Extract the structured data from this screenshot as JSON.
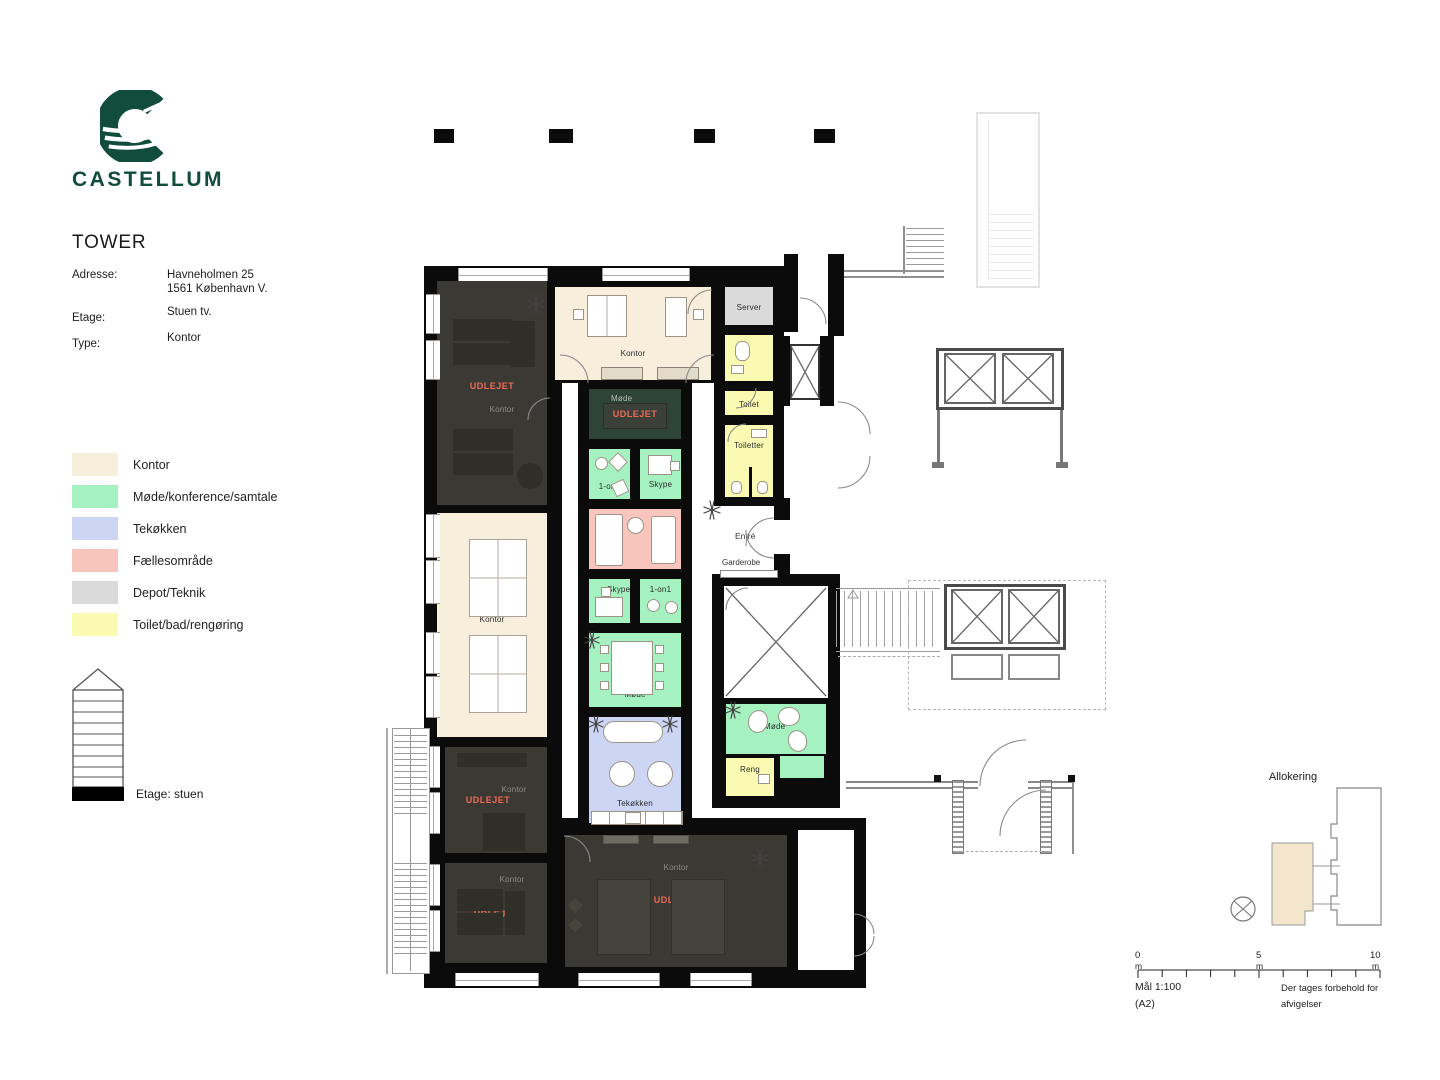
{
  "brand": {
    "name": "CASTELLUM",
    "logo_color": "#114c3c"
  },
  "header": {
    "title": "TOWER",
    "address_label": "Adresse:",
    "address_line1": "Havneholmen 25",
    "address_line2": "1561 København V.",
    "floor_label": "Etage:",
    "floor_value": "Stuen tv.",
    "type_label": "Type:",
    "type_value": "Kontor"
  },
  "legend": {
    "items": [
      {
        "label": "Kontor",
        "color": "#f7eedb"
      },
      {
        "label": "Møde/konference/samtale",
        "color": "#a5f1c0"
      },
      {
        "label": "Tekøkken",
        "color": "#ccd5f4"
      },
      {
        "label": "Fællesområde",
        "color": "#f7c5bc"
      },
      {
        "label": "Depot/Teknik",
        "color": "#dadada"
      },
      {
        "label": "Toilet/bad/rengøring",
        "color": "#fafab2"
      }
    ],
    "floor_note": "Etage: stuen"
  },
  "plan": {
    "status_color": "#ee6a55",
    "rooms": {
      "a1": {
        "label": "Kontor",
        "status": "UDLEJET"
      },
      "a2": {
        "label": "Kontor"
      },
      "a3": {
        "label": "Kontor",
        "status": "UDLEJET"
      },
      "a4": {
        "label": "Kontor",
        "status": "UDLEJET"
      },
      "b1": {
        "label": "Kontor"
      },
      "b2": {
        "label": "Møde",
        "status": "UDLEJET"
      },
      "b3": {
        "label": "1-on1"
      },
      "b4": {
        "label": "Skype"
      },
      "b6": {
        "label": "Skype"
      },
      "b7": {
        "label": "1-on1"
      },
      "b8": {
        "label": "Møde"
      },
      "b9": {
        "label": "Tekøkken"
      },
      "c1": {
        "label": "Server"
      },
      "c3": {
        "label": "Toilet"
      },
      "c4": {
        "label": "Toiletter"
      },
      "c5": {
        "label": "Møde"
      },
      "c7": {
        "label": "Reng"
      },
      "d": {
        "label": "Kontor",
        "status": "UDLEJET"
      }
    },
    "areas": {
      "entre": "Entré",
      "garderobe": "Garderobe"
    }
  },
  "allocation": {
    "title": "Allokering"
  },
  "scalebar": {
    "tick0": "0",
    "tick5": "5",
    "tick10": "10",
    "unit": "m",
    "scale_line1": "Mål 1:100",
    "scale_line2": "(A2)",
    "disclaimer_line1": "Der tages forbehold for",
    "disclaimer_line2": "afvigelser"
  }
}
